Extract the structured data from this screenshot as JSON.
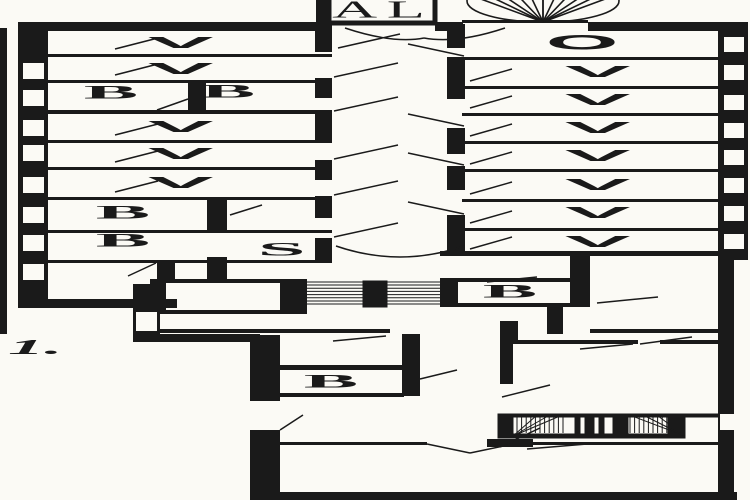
{
  "document_type": "architectural floor plan drawing",
  "colors": {
    "ink": "#1a1a1a",
    "paper": "#fbfaf5"
  },
  "floor_label": "1.",
  "vestibule_label": "AL",
  "stair_hall_label": "S",
  "left_wing": {
    "ward_symbol": "V",
    "row3_bath_left": "B",
    "row3_bath_right": "B",
    "row7_bath": "B",
    "row8_bath": "B"
  },
  "right_wing": {
    "row1_symbol": "O",
    "ward_symbol": "V"
  },
  "lower_block": {
    "bath_middle": "B",
    "bath_right": "B"
  }
}
